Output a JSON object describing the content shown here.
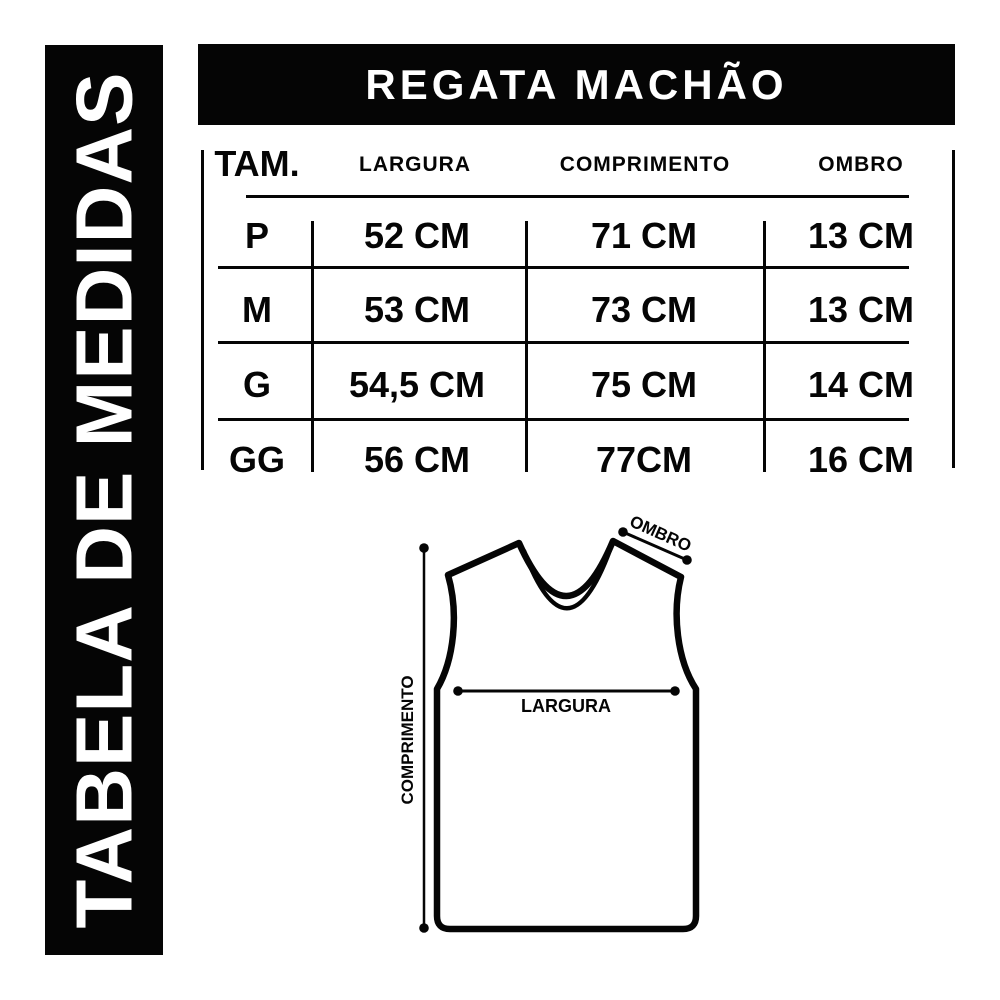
{
  "banner": {
    "label": "TABELA DE MEDIDAS"
  },
  "header": {
    "title": "REGATA MACHÃO"
  },
  "table": {
    "columns": [
      "TAM.",
      "LARGURA",
      "COMPRIMENTO",
      "OMBRO"
    ],
    "rows": [
      {
        "size": "P",
        "largura": "52 CM",
        "comprimento": "71 CM",
        "ombro": "13 CM"
      },
      {
        "size": "M",
        "largura": "53 CM",
        "comprimento": "73 CM",
        "ombro": "13 CM"
      },
      {
        "size": "G",
        "largura": "54,5 CM",
        "comprimento": "75 CM",
        "ombro": "14 CM"
      },
      {
        "size": "GG",
        "largura": "56 CM",
        "comprimento": "77CM",
        "ombro": "16 CM"
      }
    ]
  },
  "diagram": {
    "labels": {
      "ombro": "OMBRO",
      "largura": "LARGURA",
      "comprimento": "COMPRIMENTO"
    }
  },
  "colors": {
    "ink": "#050505",
    "background": "#ffffff"
  }
}
